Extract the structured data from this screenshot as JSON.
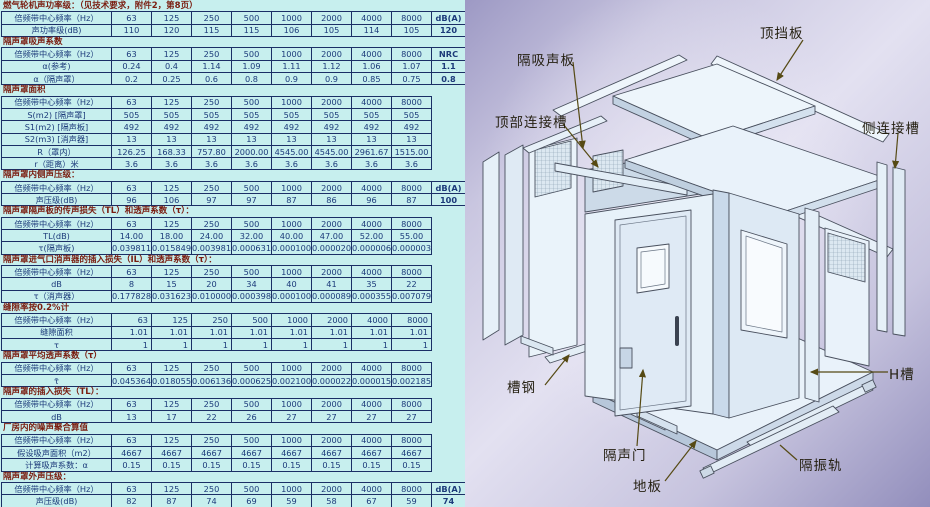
{
  "colors": {
    "table_background": "#c7efee",
    "table_grid": "#1b2f66",
    "table_text": "#1c3a7a",
    "section_title_text": "#7a1d10",
    "diagram_background": "#b8b5d6",
    "panel_fill": "#e9f2fa",
    "leader_line": "#564a14"
  },
  "left_table": {
    "sections": [
      {
        "title": "燃气轮机声功率级：（见技术要求，附件2，第8页）",
        "rows": [
          {
            "label": "倍频带中心频率（Hz）",
            "cells": [
              "63",
              "125",
              "250",
              "500",
              "1000",
              "2000",
              "4000",
              "8000",
              "dB(A)"
            ]
          },
          {
            "label": "声功率级(dB)",
            "cells": [
              "110",
              "120",
              "115",
              "115",
              "106",
              "105",
              "114",
              "105",
              "120"
            ]
          }
        ]
      },
      {
        "title": "隔声罩吸声系数",
        "rows": [
          {
            "label": "倍频带中心频率（Hz）",
            "cells": [
              "63",
              "125",
              "250",
              "500",
              "1000",
              "2000",
              "4000",
              "8000",
              "NRC"
            ]
          },
          {
            "label": "α(参考)",
            "cells": [
              "0.24",
              "0.4",
              "1.14",
              "1.09",
              "1.11",
              "1.12",
              "1.06",
              "1.07",
              "1.1"
            ]
          },
          {
            "label": "α（隔声罩）",
            "cells": [
              "0.2",
              "0.25",
              "0.6",
              "0.8",
              "0.9",
              "0.9",
              "0.85",
              "0.75",
              "0.8"
            ]
          }
        ]
      },
      {
        "title": "隔声罩面积",
        "rows": [
          {
            "label": "倍频带中心频率（Hz）",
            "cells": [
              "63",
              "125",
              "250",
              "500",
              "1000",
              "2000",
              "4000",
              "8000"
            ]
          },
          {
            "label": "S(m2) [隔声罩]",
            "cells": [
              "505",
              "505",
              "505",
              "505",
              "505",
              "505",
              "505",
              "505"
            ]
          },
          {
            "label": "S1(m2) [隔声板]",
            "cells": [
              "492",
              "492",
              "492",
              "492",
              "492",
              "492",
              "492",
              "492"
            ]
          },
          {
            "label": "S2(m3) [消声器]",
            "cells": [
              "13",
              "13",
              "13",
              "13",
              "13",
              "13",
              "13",
              "13"
            ]
          },
          {
            "label": "R（罩内）",
            "cells": [
              "126.25",
              "168.33",
              "757.80",
              "2000.00",
              "4545.00",
              "4545.00",
              "2961.67",
              "1515.00"
            ]
          },
          {
            "label": "r（距离）米",
            "cells": [
              "3.6",
              "3.6",
              "3.6",
              "3.6",
              "3.6",
              "3.6",
              "3.6",
              "3.6"
            ]
          }
        ]
      },
      {
        "title": "隔声罩内侧声压级：",
        "rows": [
          {
            "label": "倍频带中心频率（Hz）",
            "cells": [
              "63",
              "125",
              "250",
              "500",
              "1000",
              "2000",
              "4000",
              "8000",
              "dB(A)"
            ]
          },
          {
            "label": "声压级(dB)",
            "cells": [
              "96",
              "106",
              "97",
              "97",
              "87",
              "86",
              "96",
              "87",
              "100"
            ]
          }
        ]
      },
      {
        "title": "隔声罩隔声板的传声损失（TL）和透声系数（τ）：",
        "rows": [
          {
            "label": "倍频带中心频率（Hz）",
            "cells": [
              "63",
              "125",
              "250",
              "500",
              "1000",
              "2000",
              "4000",
              "8000"
            ]
          },
          {
            "label": "TL(dB)",
            "cells": [
              "14.00",
              "18.00",
              "24.00",
              "32.00",
              "40.00",
              "47.00",
              "52.00",
              "55.00"
            ]
          },
          {
            "label": "τ(隔声板)",
            "cells": [
              "0.039811",
              "0.015849",
              "0.003981",
              "0.000631",
              "0.000100",
              "0.000020",
              "0.000006",
              "0.000003"
            ]
          }
        ]
      },
      {
        "title": "隔声罩进气口消声器的插入损失（IL）和透声系数（τ）：",
        "rows": [
          {
            "label": "倍频带中心频率（Hz）",
            "cells": [
              "63",
              "125",
              "250",
              "500",
              "1000",
              "2000",
              "4000",
              "8000"
            ]
          },
          {
            "label": "dB",
            "cells": [
              "8",
              "15",
              "20",
              "34",
              "40",
              "41",
              "35",
              "22"
            ]
          },
          {
            "label": "τ（消声器）",
            "cells": [
              "0.177828",
              "0.031623",
              "0.010000",
              "0.000398",
              "0.000100",
              "0.000089",
              "0.000355",
              "0.007079"
            ]
          }
        ]
      },
      {
        "title": "缝隙率按0.2%计",
        "align": "right",
        "rows": [
          {
            "label": "倍频带中心频率（Hz）",
            "cells": [
              "63",
              "125",
              "250",
              "500",
              "1000",
              "2000",
              "4000",
              "8000"
            ]
          },
          {
            "label": "缝隙面积",
            "cells": [
              "1.01",
              "1.01",
              "1.01",
              "1.01",
              "1.01",
              "1.01",
              "1.01",
              "1.01"
            ]
          },
          {
            "label": "τ",
            "cells": [
              "1",
              "1",
              "1",
              "1",
              "1",
              "1",
              "1",
              "1"
            ]
          }
        ]
      },
      {
        "title": "隔声罩平均透声系数（τ）",
        "rows": [
          {
            "label": "倍频带中心频率（Hz）",
            "cells": [
              "63",
              "125",
              "250",
              "500",
              "1000",
              "2000",
              "4000",
              "8000"
            ]
          },
          {
            "label": "τ̄",
            "cells": [
              "0.045364",
              "0.018055",
              "0.006136",
              "0.000625",
              "0.002100",
              "0.000022",
              "0.000015",
              "0.002185"
            ]
          }
        ]
      },
      {
        "title": "隔声罩的插入损失（TL）：",
        "rows": [
          {
            "label": "倍频带中心频率（Hz）",
            "cells": [
              "63",
              "125",
              "250",
              "500",
              "1000",
              "2000",
              "4000",
              "8000"
            ]
          },
          {
            "label": "dB",
            "cells": [
              "13",
              "17",
              "22",
              "26",
              "27",
              "27",
              "27",
              "27"
            ]
          }
        ]
      },
      {
        "title": "厂房内的噪声聚合算值",
        "rows": [
          {
            "label": "倍频带中心频率（Hz）",
            "cells": [
              "63",
              "125",
              "250",
              "500",
              "1000",
              "2000",
              "4000",
              "8000"
            ]
          },
          {
            "label": "假设吸声面积（m2）",
            "cells": [
              "4667",
              "4667",
              "4667",
              "4667",
              "4667",
              "4667",
              "4667",
              "4667"
            ]
          },
          {
            "label": "计算吸声系数：α",
            "cells": [
              "0.15",
              "0.15",
              "0.15",
              "0.15",
              "0.15",
              "0.15",
              "0.15",
              "0.15"
            ]
          }
        ]
      },
      {
        "title": "隔声罩外声压级：",
        "rows": [
          {
            "label": "倍频带中心频率（Hz）",
            "cells": [
              "63",
              "125",
              "250",
              "500",
              "1000",
              "2000",
              "4000",
              "8000",
              "dB(A)"
            ]
          },
          {
            "label": "声压级(dB)",
            "cells": [
              "82",
              "87",
              "74",
              "69",
              "59",
              "58",
              "67",
              "59",
              "74"
            ]
          }
        ]
      }
    ]
  },
  "diagram": {
    "labels": [
      {
        "id": "top-baffle",
        "text": "顶挡板"
      },
      {
        "id": "insulation-panel",
        "text": "隔吸声板"
      },
      {
        "id": "top-channel",
        "text": "顶部连接槽"
      },
      {
        "id": "side-channel",
        "text": "侧连接槽"
      },
      {
        "id": "h-channel",
        "text": "H槽"
      },
      {
        "id": "channel-steel",
        "text": "槽钢"
      },
      {
        "id": "door",
        "text": "隔声门"
      },
      {
        "id": "floor",
        "text": "地板"
      },
      {
        "id": "vibration-rail",
        "text": "隔振轨"
      }
    ]
  }
}
